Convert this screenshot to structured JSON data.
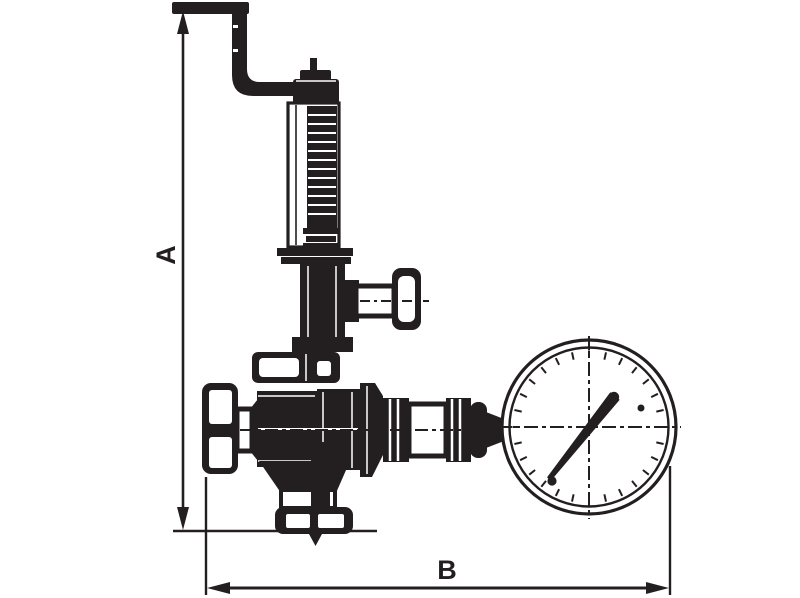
{
  "meta": {
    "description": "Technical dimension line drawing of a spring-loaded pressure reducing / safety valve with top lever, spring housing, two handwheels, bottom outlet flange and a pressure gauge (manometer)",
    "canvas": {
      "width": 800,
      "height": 598
    }
  },
  "colors": {
    "ink": "#231F20",
    "paper": "#FFFFFF"
  },
  "dimensions": {
    "a_label": "A",
    "b_label": "B"
  },
  "gauge": {
    "tick_count": 28,
    "needle_angle_deg": 51,
    "has_crosshair_centerlines": true,
    "ring_style": "double-circle"
  },
  "components": [
    "dimension-a-vertical",
    "dimension-b-horizontal",
    "bent-lever-handle",
    "stem-pin-and-cap",
    "spring-housing-with-coils",
    "adjusting-nut",
    "bonnet-flange",
    "side-handwheel-right",
    "hex-flange",
    "valve-body",
    "inlet-handwheel-left",
    "union-connector-ribbed",
    "pressure-gauge",
    "outlet-funnel",
    "bottom-outlet-flange"
  ]
}
